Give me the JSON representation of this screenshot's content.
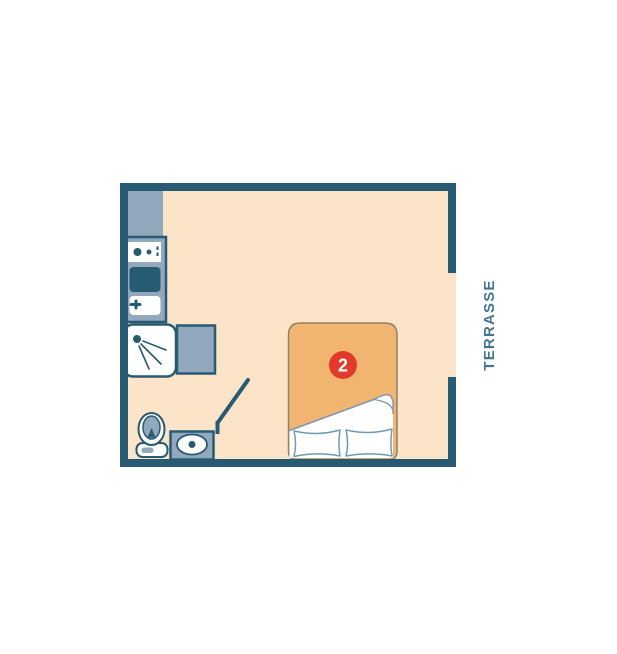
{
  "floorplan": {
    "terrace_label": {
      "text": "TERRASSE",
      "color": "#45748f",
      "orientation": "vertical-bottom-to-top"
    },
    "room_badge": {
      "number": "2",
      "background": "#e13a2c",
      "text_color": "#ffffff"
    },
    "fixtures": [
      "refrigerator-counter",
      "stove-top",
      "kitchen-sink",
      "shower",
      "bathroom-counter",
      "bathroom-door",
      "toilet",
      "washbasin",
      "double-bed",
      "pillow-left",
      "pillow-right"
    ],
    "openings": [
      "terrace-opening-right-wall"
    ],
    "colors": {
      "wall": "#275a73",
      "floor": "#fce4c8",
      "furniture_gray": "#92a8bd",
      "bed_blanket": "#f2b571",
      "bed_outline": "#8d8266",
      "pillow_outline": "#6f9ab5",
      "sheet_fold_line": "#7d96a9",
      "badge_red": "#e13a2c",
      "label_teal": "#45748f",
      "white": "#ffffff"
    }
  }
}
